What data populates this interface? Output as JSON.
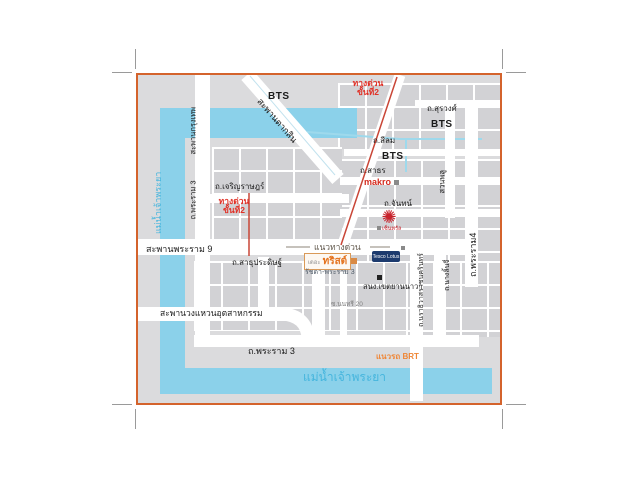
{
  "colors": {
    "border": "#d4632c",
    "river": "#8bd1ea",
    "expressway_red": "#c94637",
    "brt_orange": "#ef8636",
    "trust_orange": "#e4731f",
    "central_red": "#c8232c",
    "lotus_navy": "#1c3a6e"
  },
  "rivers": {
    "chao_phraya_left": "แม่น้ำเจ้าพระยา",
    "chao_phraya_bottom": "แม่น้ำเจ้าพระยา"
  },
  "bridges": {
    "krung_thep": "สะพานกรุงเทพ",
    "taksin": "สะพานตากสิน",
    "rama9": "สะพานพระราม 9",
    "industrial_ring": "สะพานวงแหวนอุตสาหกรรม"
  },
  "roads": {
    "rama3_left": "ถ.พระราม 3",
    "rama3_bottom": "ถ.พระราม 3",
    "charoen_rat": "ถ.เจริญราษฎร์",
    "chan": "ถ.จันทน์",
    "sathorn": "ถ.สาธร",
    "silom": "ถ.สีลม",
    "surawong": "ถ.สุรวงศ์",
    "sathu_pradit": "ถ.สาธุประดิษฐ์",
    "narathiwas": "ถ.นราธิวาสราชนครินทร์",
    "nang_linchi": "ถ.นางลิ้นจี่",
    "rama4": "ถ.พระราม4",
    "suan_phlu": "สวนพลู",
    "soi_nonsi20": "ซ.นนทรี 20"
  },
  "expressway": {
    "stage2_line1": "ทางด่วน",
    "stage2_line2": "ขั้นที่2",
    "alignment": "แนวทางด่วน"
  },
  "transit": {
    "bts": "BTS",
    "brt_line": "แนวรถ BRT"
  },
  "landmarks": {
    "makro": "makro",
    "central": "เซ็นทรัล",
    "trust_prefix": "เดอะ",
    "trust_name": "ทริสต์",
    "trust_sub": "รัชดา-พระราม 3",
    "lotus": "Tesco Lotus",
    "yannawa_office": "สนง.เขตยานนาวา"
  }
}
